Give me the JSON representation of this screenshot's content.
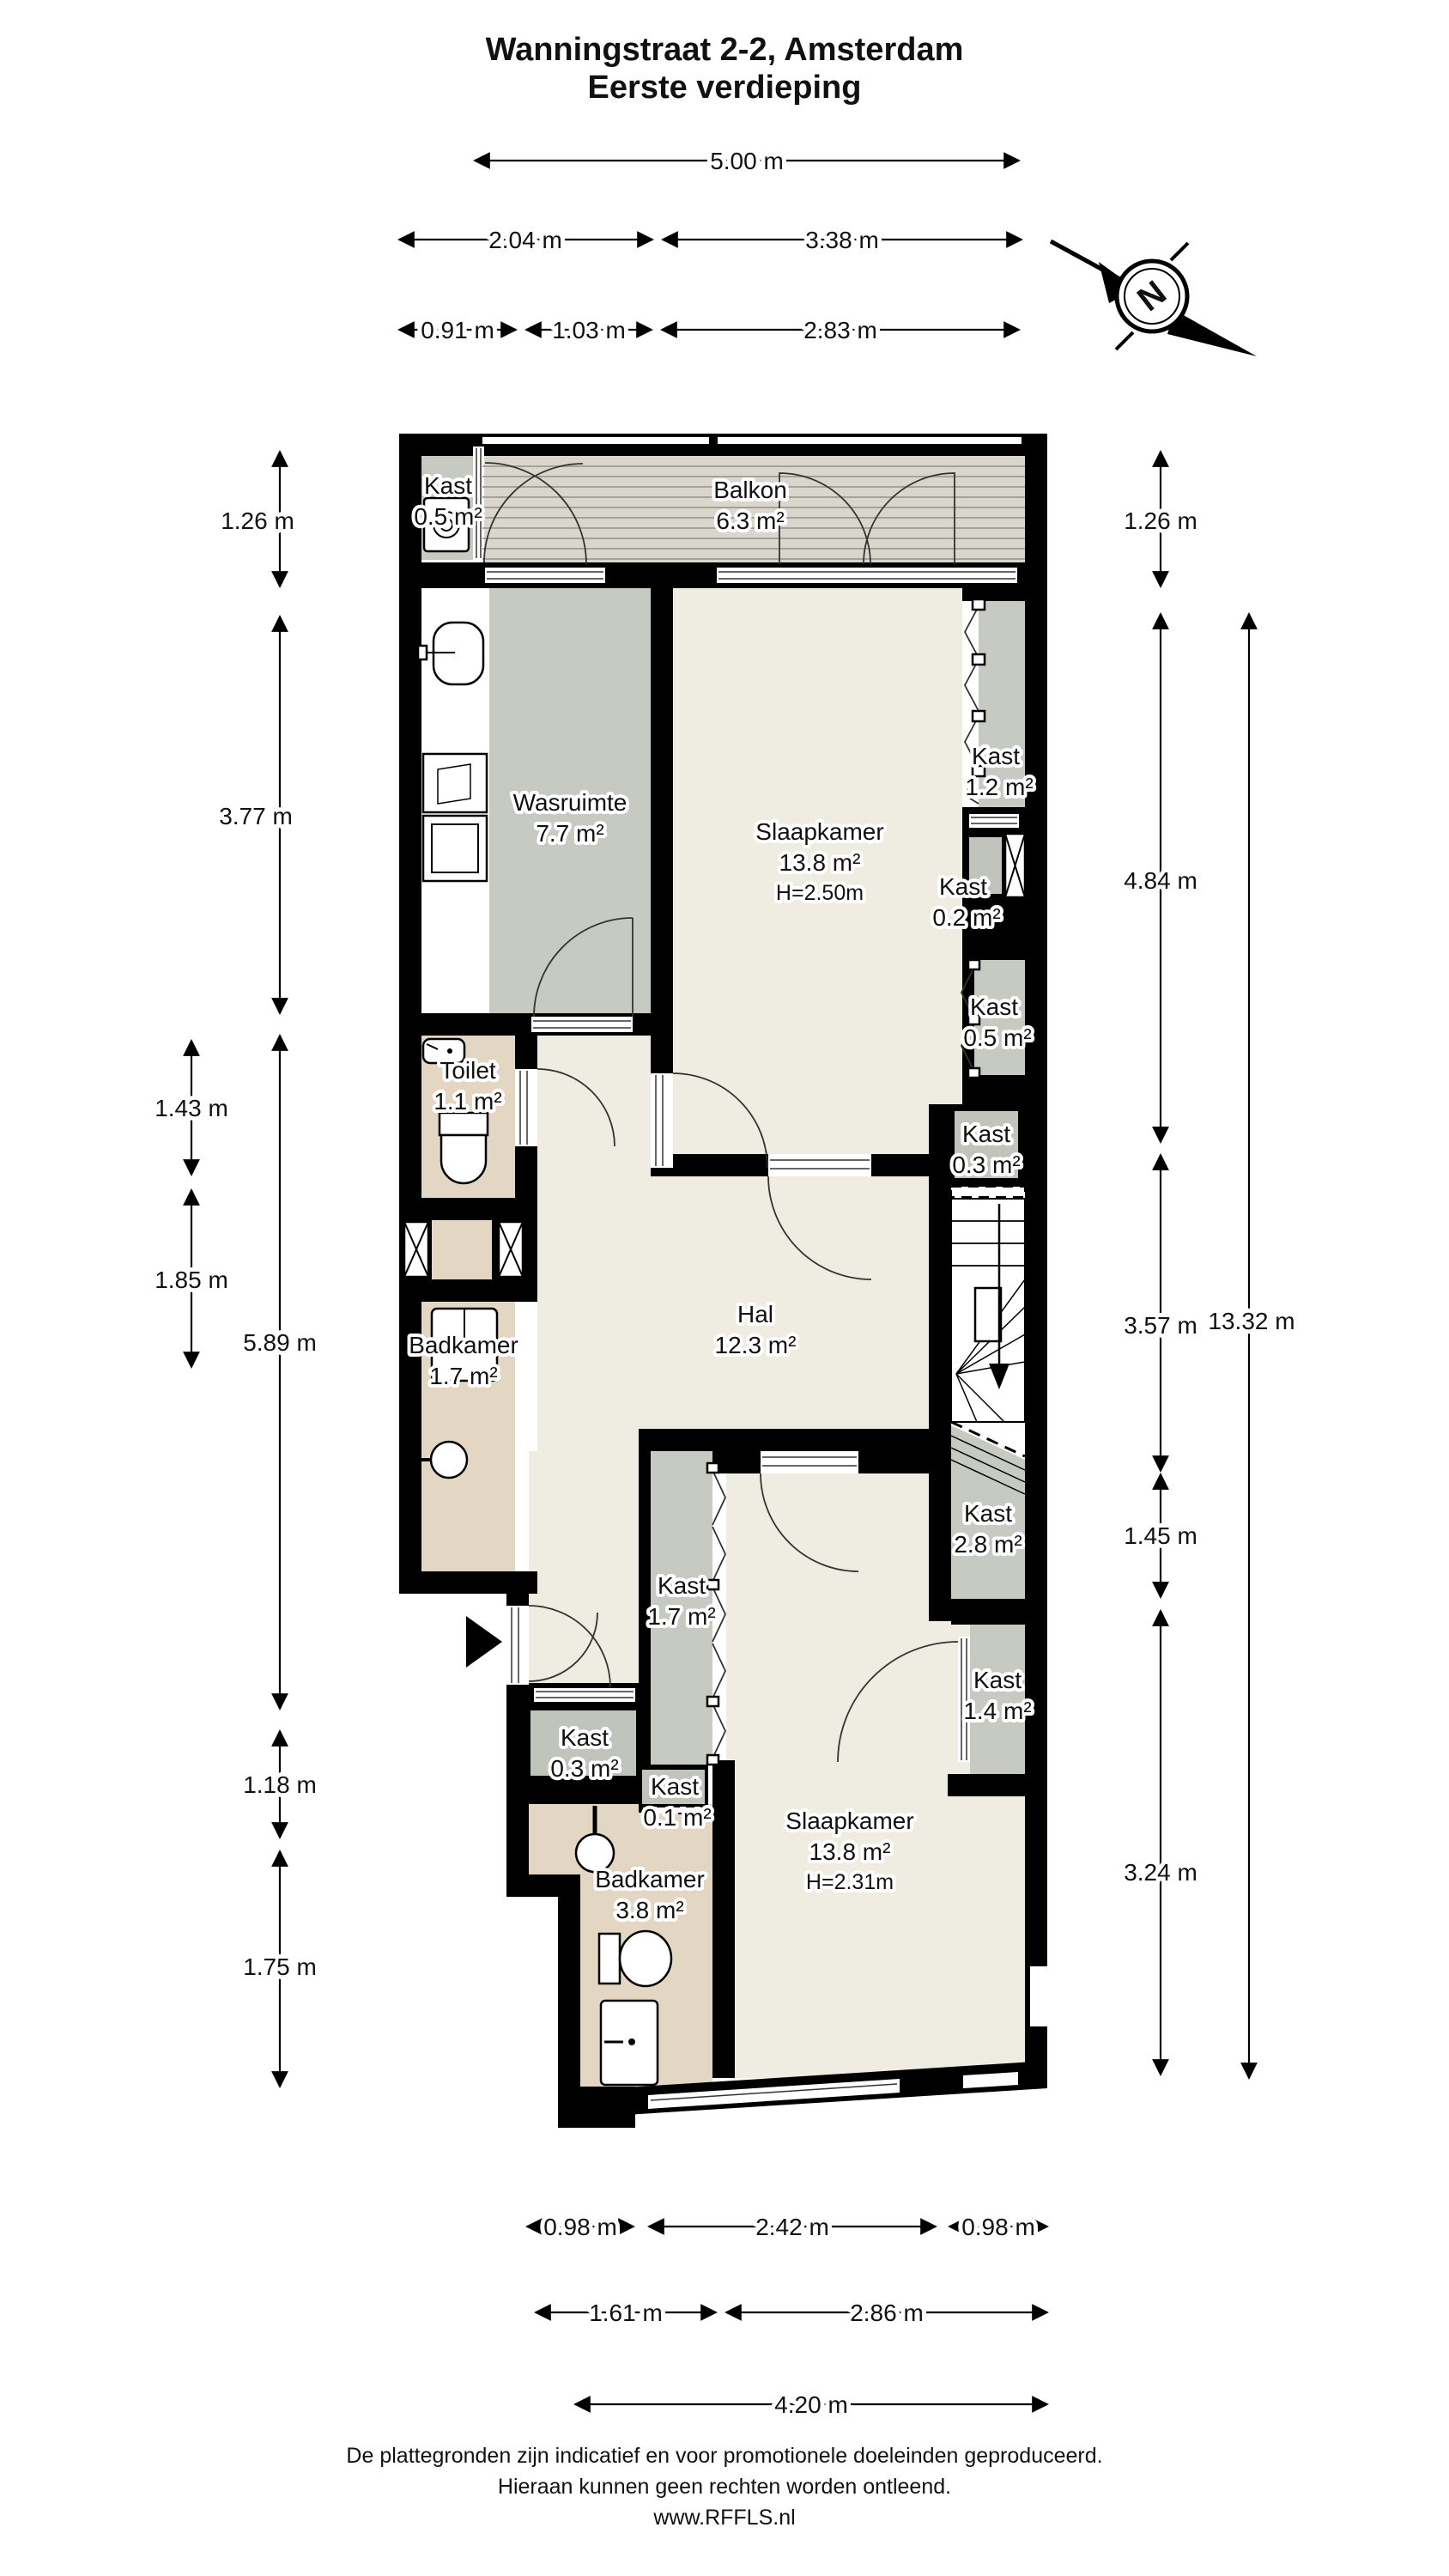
{
  "title": {
    "line1": "Wanningstraat 2-2, Amsterdam",
    "line2": "Eerste verdieping"
  },
  "compass": {
    "label": "N"
  },
  "rooms": {
    "kast_top": {
      "name": "Kast",
      "area": "0.5 m²"
    },
    "balkon": {
      "name": "Balkon",
      "area": "6.3 m²"
    },
    "wasruimte": {
      "name": "Wasruimte",
      "area": "7.7 m²"
    },
    "slaapkamer1": {
      "name": "Slaapkamer",
      "area": "13.8 m²",
      "height": "H=2.50m"
    },
    "kast_1_2": {
      "name": "Kast",
      "area": "1.2 m²"
    },
    "kast_0_2": {
      "name": "Kast",
      "area": "0.2 m²"
    },
    "kast_0_5_rechts": {
      "name": "Kast",
      "area": "0.5 m²"
    },
    "toilet": {
      "name": "Toilet",
      "area": "1.1 m²"
    },
    "badkamer_boven": {
      "name": "Badkamer",
      "area": "1.7 m²"
    },
    "hal": {
      "name": "Hal",
      "area": "12.3 m²"
    },
    "kast_0_3_rechts": {
      "name": "Kast",
      "area": "0.3 m²"
    },
    "kast_2_8": {
      "name": "Kast",
      "area": "2.8 m²"
    },
    "kast_1_7": {
      "name": "Kast",
      "area": "1.7 m²"
    },
    "kast_1_4": {
      "name": "Kast",
      "area": "1.4 m²"
    },
    "kast_0_3_links": {
      "name": "Kast",
      "area": "0.3 m²"
    },
    "kast_0_1": {
      "name": "Kast",
      "area": "0.1 m²"
    },
    "badkamer_onder": {
      "name": "Badkamer",
      "area": "3.8 m²"
    },
    "slaapkamer2": {
      "name": "Slaapkamer",
      "area": "13.8 m²",
      "height": "H=2.31m"
    }
  },
  "dimensions": {
    "top": [
      {
        "label": "5.00 m"
      },
      {
        "label": "2.04 m"
      },
      {
        "label": "3.38 m"
      },
      {
        "label": "0.91 m"
      },
      {
        "label": "1.03 m"
      },
      {
        "label": "2.83 m"
      }
    ],
    "left": [
      {
        "label": "1.26 m"
      },
      {
        "label": "3.77 m"
      },
      {
        "label": "1.43 m"
      },
      {
        "label": "1.85 m"
      },
      {
        "label": "5.89 m"
      },
      {
        "label": "1.18 m"
      },
      {
        "label": "1.75 m"
      }
    ],
    "right": [
      {
        "label": "1.26 m"
      },
      {
        "label": "4.84 m"
      },
      {
        "label": "3.57 m"
      },
      {
        "label": "13.32 m"
      },
      {
        "label": "1.45 m"
      },
      {
        "label": "3.24 m"
      }
    ],
    "bottom": [
      {
        "label": "0.98 m"
      },
      {
        "label": "2.42 m"
      },
      {
        "label": "0.98 m"
      },
      {
        "label": "1.61 m"
      },
      {
        "label": "2.86 m"
      },
      {
        "label": "4.20 m"
      }
    ]
  },
  "footer": {
    "line1": "De plattegronden zijn indicatief en voor promotionele doeleinden geproduceerd.",
    "line2": "Hieraan kunnen geen rechten worden ontleend.",
    "line3": "www.RFFLS.nl"
  },
  "colors": {
    "wall": "#000000",
    "floor_light": "#efece1",
    "floor_gray": "#c7cac2",
    "floor_tan": "#e3d6c2",
    "balcony_deck": "#d9d7cd"
  }
}
